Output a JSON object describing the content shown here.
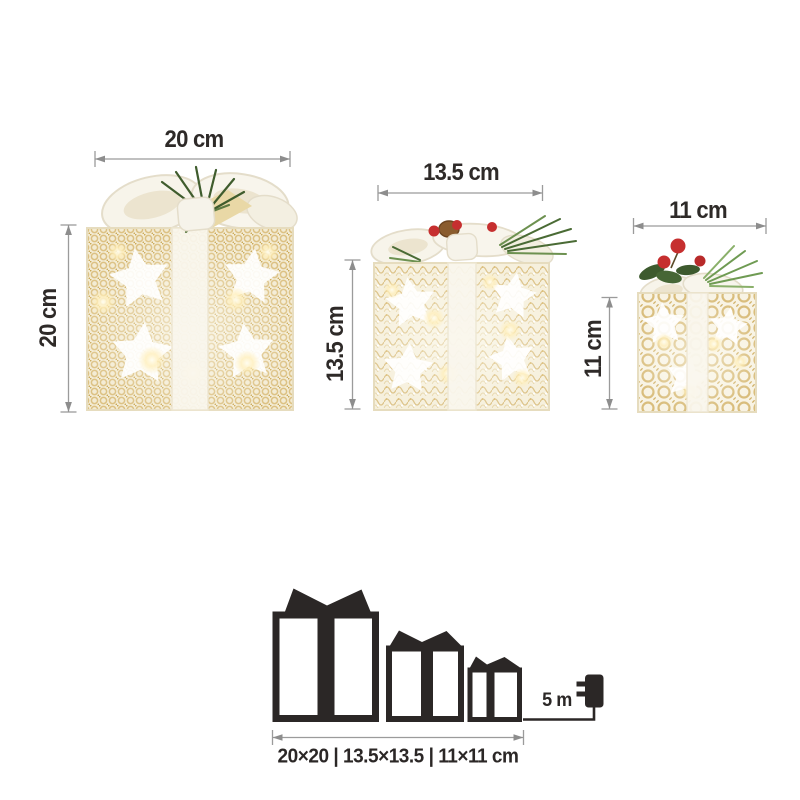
{
  "dimensions": {
    "large": {
      "width_label": "20 cm",
      "height_label": "20 cm"
    },
    "medium": {
      "width_label": "13.5 cm",
      "height_label": "13.5 cm"
    },
    "small": {
      "width_label": "11 cm",
      "height_label": "11 cm"
    }
  },
  "pictogram": {
    "cable_length_label": "5 m",
    "size_summary_label": "20×20 | 13.5×13.5 | 11×11 cm",
    "icons": [
      "gift-box-large-icon",
      "gift-box-medium-icon",
      "gift-box-small-icon",
      "power-adapter-icon",
      "cable-line"
    ]
  },
  "colors": {
    "background": "#ffffff",
    "dimension_line": "#9b9b9b",
    "label_text": "#2e2a28",
    "pictogram_black": "#2b2726",
    "box_cream": "#f4ecd4",
    "box_gold": "#d8bd80",
    "ribbon_white": "#f8f6ef",
    "pine_green": "#41602f",
    "bright_green": "#6f9b53",
    "berry_red": "#c62f2f",
    "pinecone_brown": "#8a5c2e",
    "glow_warm": "#ffeeb8"
  }
}
